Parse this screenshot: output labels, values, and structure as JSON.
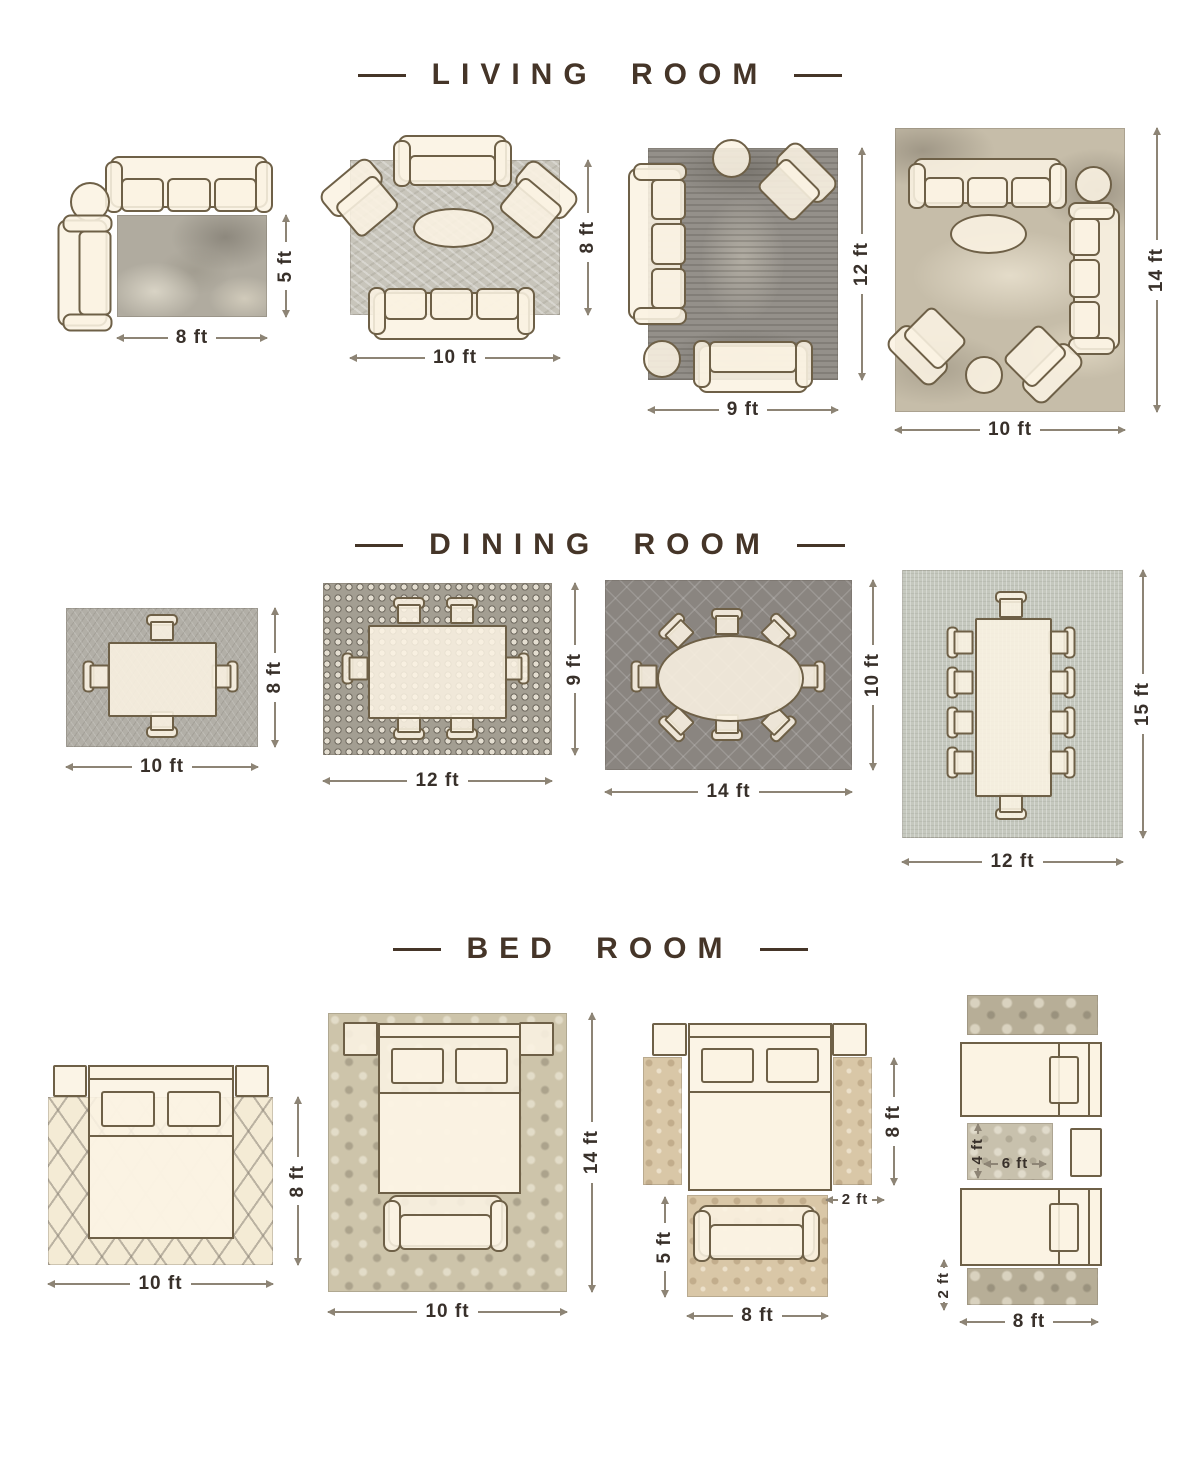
{
  "title_color": "#453528",
  "dimension_text_color": "#38302a",
  "furniture_fill": "#faf2e3",
  "furniture_outline": "#6e6047",
  "sections": [
    {
      "title": "LIVING ROOM",
      "layouts": [
        {
          "name": "living-8x5",
          "width_label": "8 ft",
          "height_label": "5 ft",
          "furniture": [
            "three-seat-sofa",
            "round-side-table",
            "settee"
          ]
        },
        {
          "name": "living-10x8",
          "width_label": "10 ft",
          "height_label": "8 ft",
          "furniture": [
            "settee",
            "accent-chair",
            "accent-chair",
            "oval-coffee-table",
            "three-seat-sofa"
          ]
        },
        {
          "name": "living-9x12",
          "width_label": "9 ft",
          "height_label": "12 ft",
          "furniture": [
            "round-side-table",
            "accent-chair",
            "three-seat-sofa",
            "round-side-table",
            "settee"
          ]
        },
        {
          "name": "living-10x14",
          "width_label": "10 ft",
          "height_label": "14 ft",
          "furniture": [
            "three-seat-sofa",
            "round-side-table",
            "three-seat-sofa",
            "oval-coffee-table",
            "accent-chair",
            "round-ottoman",
            "accent-chair"
          ]
        }
      ]
    },
    {
      "title": "DINING ROOM",
      "layouts": [
        {
          "name": "dining-10x8",
          "width_label": "10 ft",
          "height_label": "8 ft",
          "furniture": [
            "dining-table",
            "4-chairs"
          ]
        },
        {
          "name": "dining-12x9",
          "width_label": "12 ft",
          "height_label": "9 ft",
          "furniture": [
            "dining-table",
            "6-chairs"
          ]
        },
        {
          "name": "dining-14x10",
          "width_label": "14 ft",
          "height_label": "10 ft",
          "furniture": [
            "oval-dining-table",
            "8-chairs"
          ]
        },
        {
          "name": "dining-12x15",
          "width_label": "12 ft",
          "height_label": "15 ft",
          "furniture": [
            "long-dining-table",
            "10-chairs"
          ]
        }
      ]
    },
    {
      "title": "BED ROOM",
      "layouts": [
        {
          "name": "bed-10x8",
          "width_label": "10 ft",
          "height_label": "8 ft",
          "furniture": [
            "queen-bed",
            "nightstand",
            "nightstand"
          ]
        },
        {
          "name": "bed-10x14",
          "width_label": "10 ft",
          "height_label": "14 ft",
          "furniture": [
            "queen-bed",
            "nightstand",
            "nightstand",
            "bench"
          ]
        },
        {
          "name": "bed-runners",
          "runner_height_label": "8 ft",
          "runner_width_label": "2 ft",
          "foot_rug_height_label": "5 ft",
          "foot_rug_width_label": "8 ft",
          "furniture": [
            "queen-bed",
            "nightstand",
            "nightstand",
            "runner-rug",
            "runner-rug",
            "bench",
            "foot-rug"
          ]
        },
        {
          "name": "bed-twin",
          "center_rug_height_label": "4 ft",
          "center_rug_width_label": "6 ft",
          "runner_height_label": "2 ft",
          "width_label": "8 ft",
          "furniture": [
            "twin-bed",
            "twin-bed",
            "runner-rug",
            "runner-rug",
            "center-rug",
            "nightstand"
          ]
        }
      ]
    }
  ]
}
